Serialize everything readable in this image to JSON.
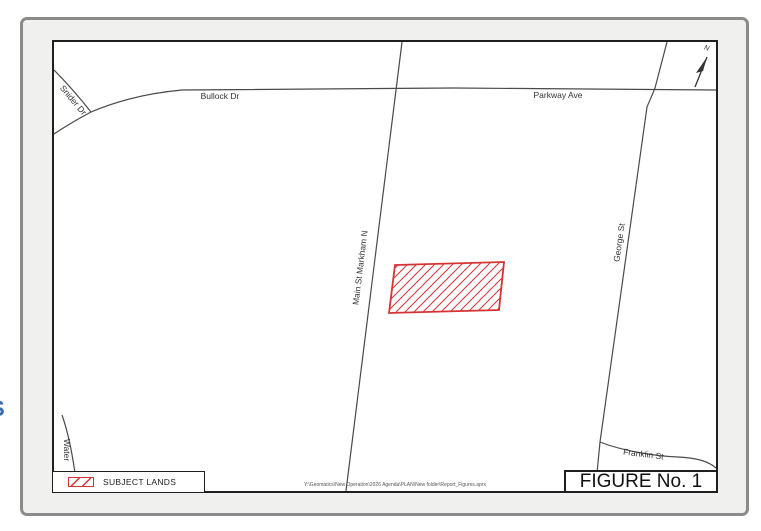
{
  "edge_text": {
    "partial": "S"
  },
  "map": {
    "north": "N",
    "streets": {
      "snider": "Snider Dr",
      "bullock": "Bullock Dr",
      "parkway": "Parkway Ave",
      "main": "Main St Markham N",
      "george": "George St",
      "water": "Water",
      "franklin": "Franklin St"
    },
    "colors": {
      "subject_lands": "#d63434",
      "road": "#4a4a4a",
      "frame": "#1f1f1f"
    }
  },
  "legend": {
    "subject_lands_label": "SUBJECT LANDS"
  },
  "title_box": {
    "label": "FIGURE No. 1"
  },
  "footer": {
    "path": "Y:\\Geomatics\\New Operation\\2026 Agenda\\PLAN\\New folder\\Report_Figures.aprx"
  }
}
